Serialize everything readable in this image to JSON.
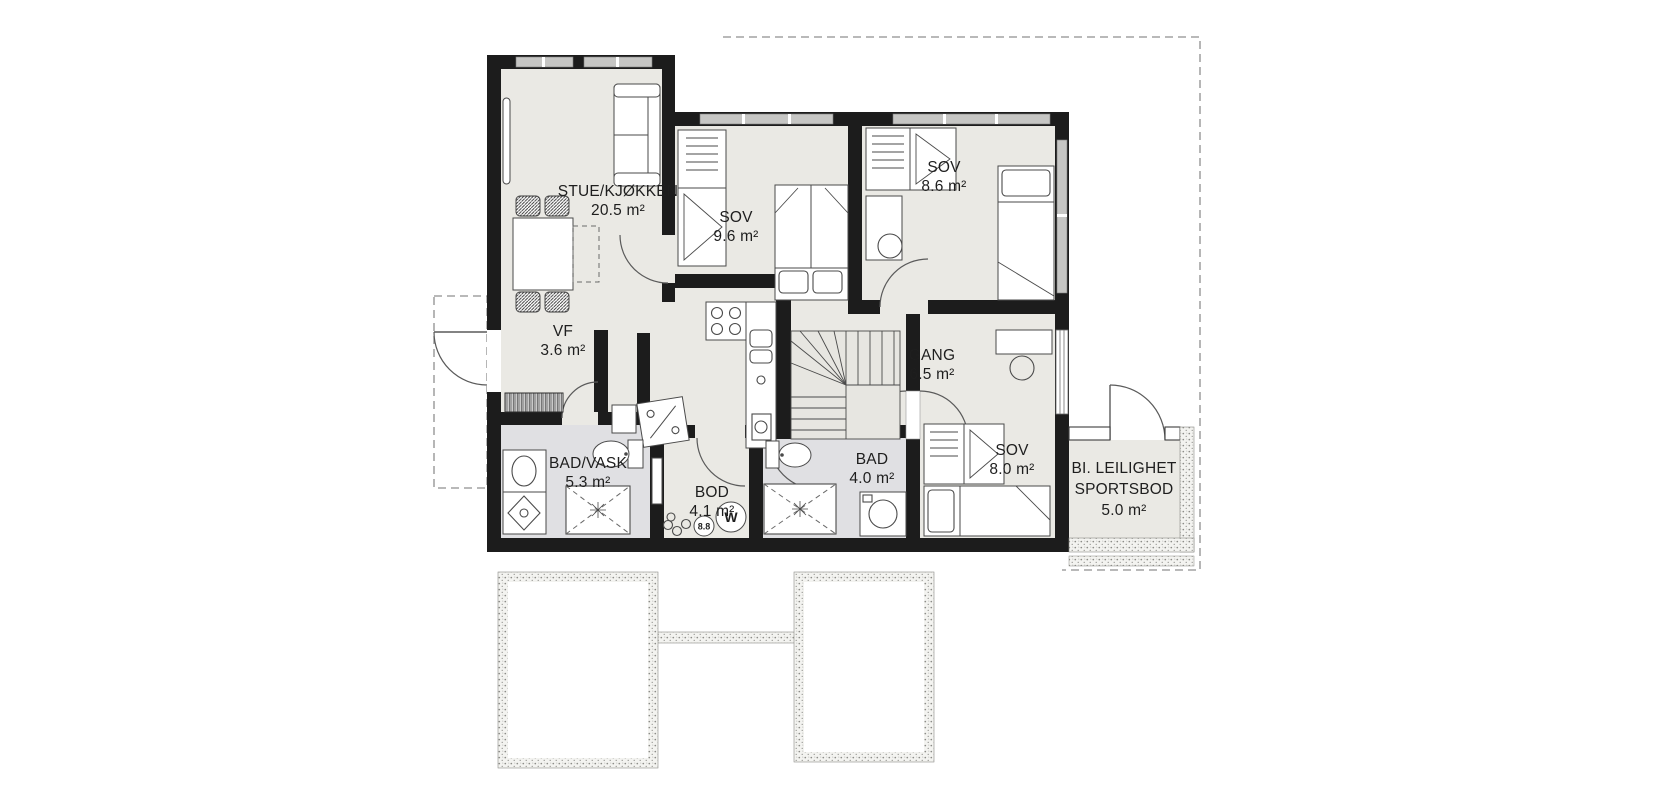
{
  "plan": {
    "type": "floor-plan",
    "language": "Norwegian",
    "rooms": [
      {
        "id": "stue",
        "name": "STUE/KJØKKEN",
        "area": "20.5 m²"
      },
      {
        "id": "sov1",
        "name": "SOV",
        "area": "9.6 m²"
      },
      {
        "id": "sov2",
        "name": "SOV",
        "area": "8.6 m²"
      },
      {
        "id": "vf",
        "name": "VF",
        "area": "3.6 m²"
      },
      {
        "id": "gang",
        "name": "GANG",
        "area": "6.5 m²"
      },
      {
        "id": "badvask",
        "name": "BAD/VASK",
        "area": "5.3 m²"
      },
      {
        "id": "bod",
        "name": "BOD",
        "area": "4.1 m²"
      },
      {
        "id": "bad",
        "name": "BAD",
        "area": "4.0 m²"
      },
      {
        "id": "sov3",
        "name": "SOV",
        "area": "8.0 m²"
      },
      {
        "id": "sportsbod",
        "name": "BI. LEILIGHET",
        "name2": "SPORTSBOD",
        "area": "5.0 m²"
      }
    ],
    "fixtures": {
      "water_heater_label": "W",
      "meter_label": "8.8"
    },
    "colors": {
      "wall": "#1c1c1c",
      "room_fill": "#eae9e4",
      "wet_room_fill": "#e0e0e3",
      "window_band": "#c6c6c4",
      "speckle": "#8b8b86",
      "dash_line": "#8f8f8f",
      "outline": "#4a4a4a"
    }
  }
}
